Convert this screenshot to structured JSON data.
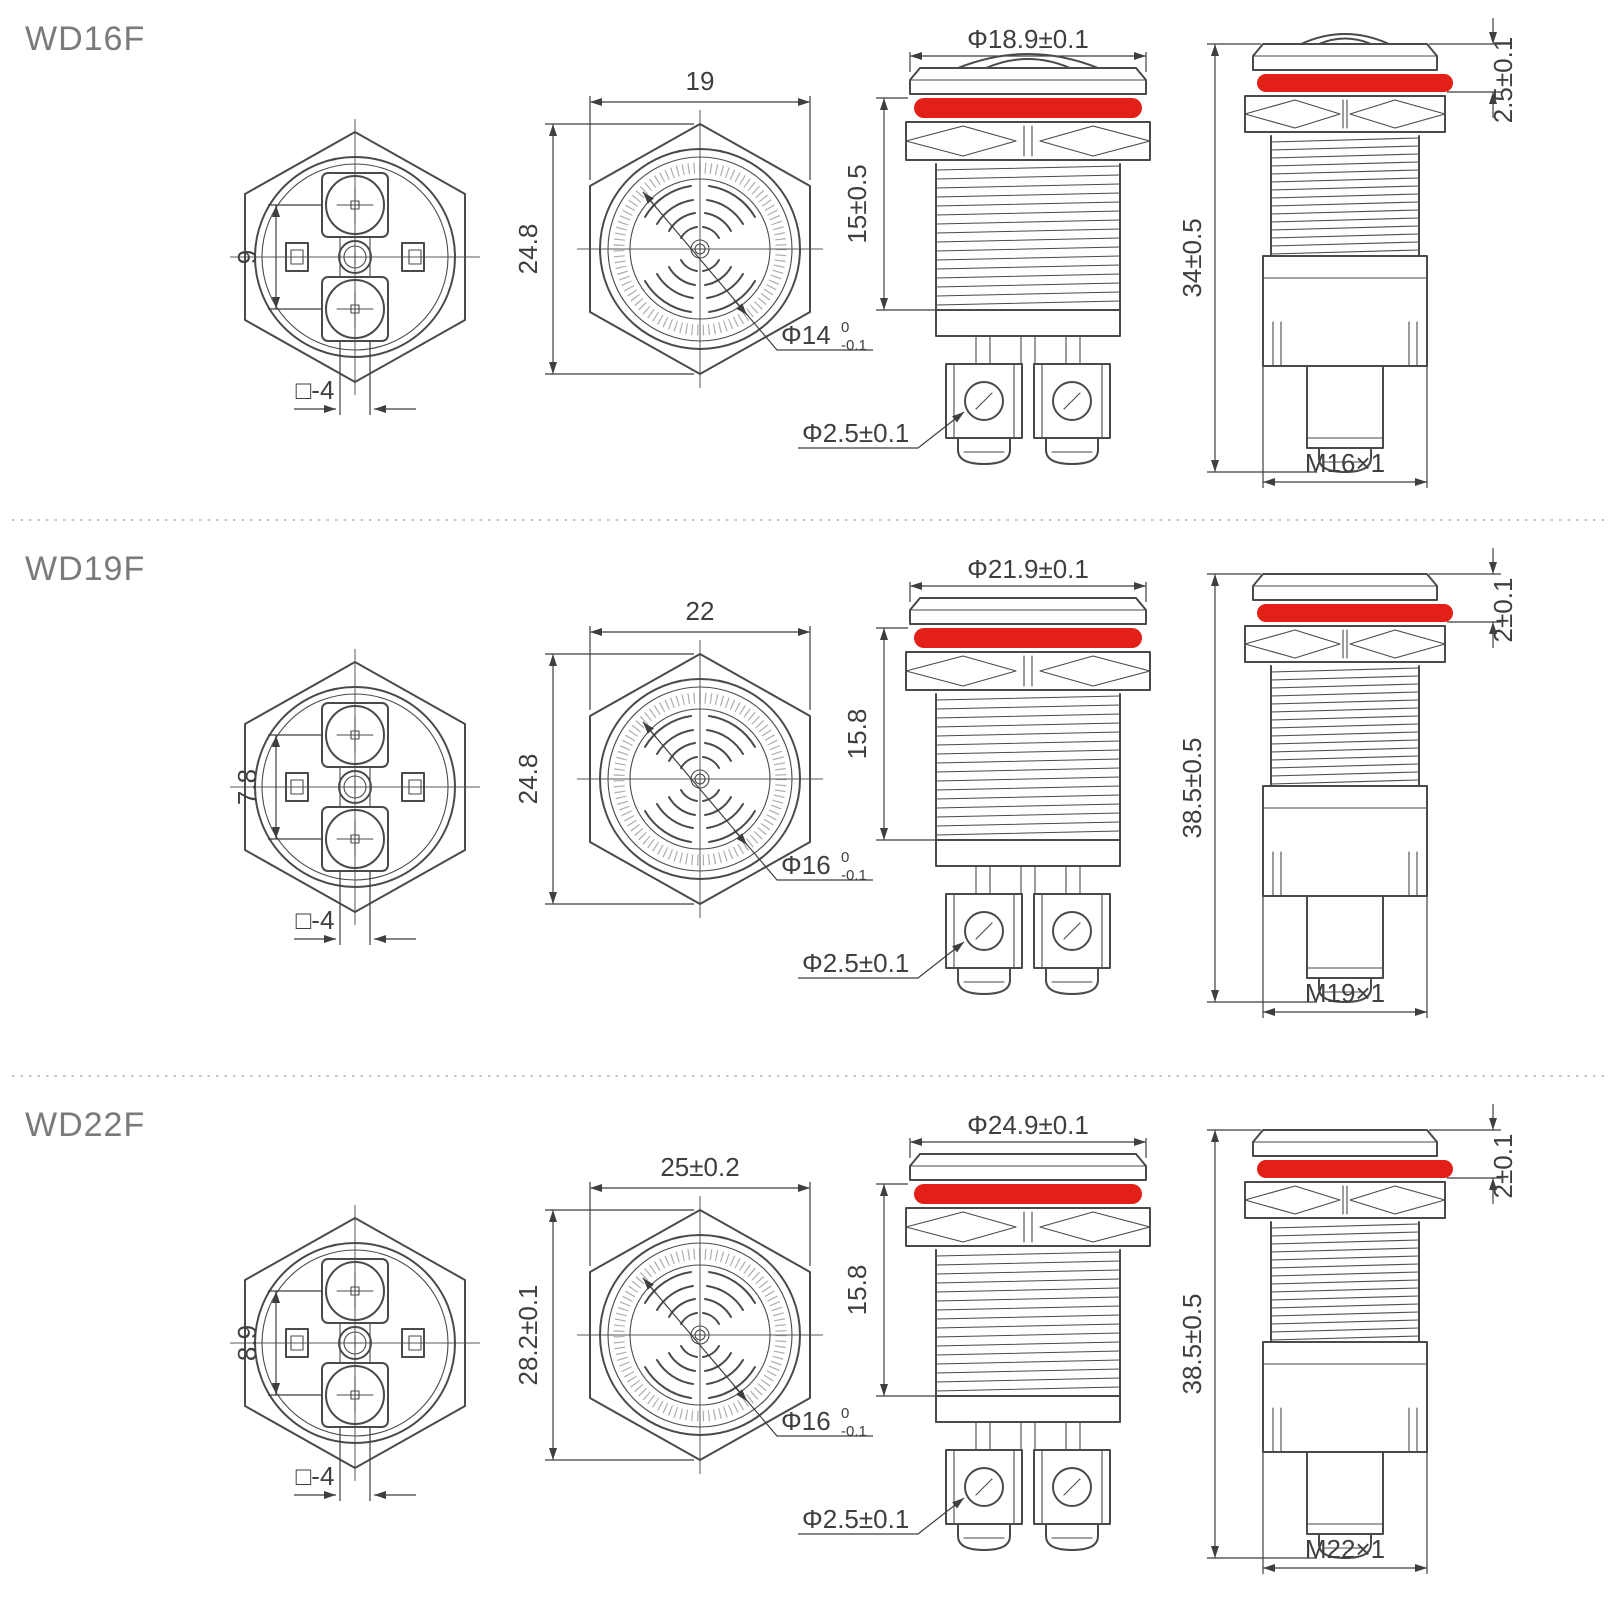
{
  "colors": {
    "line": "#4a4a4a",
    "thin": "#5a5a5a",
    "dim": "#3f3f3f",
    "red_ring": "#e32017",
    "title_text": "#7a7a7a",
    "divider": "#c6c6c6",
    "background": "#ffffff"
  },
  "sections": [
    {
      "model": "WD16F",
      "back_view": {
        "terminal_pitch": "9",
        "terminal_square": "□-4"
      },
      "front_view": {
        "width_across_flats": "19",
        "corner_height": "24.8",
        "sound_hole_dia": "Φ14",
        "tol_upper": "0",
        "tol_lower": "-0.1"
      },
      "side_view": {
        "head_dia": "Φ18.9±0.1",
        "thread_length": "15±0.5",
        "terminal_screw_dia": "Φ2.5±0.1"
      },
      "profile_view": {
        "total_height": "34±0.5",
        "head_height": "2.5±0.1",
        "thread_spec": "M16×1"
      }
    },
    {
      "model": "WD19F",
      "back_view": {
        "terminal_pitch": "7.8",
        "terminal_square": "□-4"
      },
      "front_view": {
        "width_across_flats": "22",
        "corner_height": "24.8",
        "sound_hole_dia": "Φ16",
        "tol_upper": "0",
        "tol_lower": "-0.1"
      },
      "side_view": {
        "head_dia": "Φ21.9±0.1",
        "thread_length": "15.8",
        "terminal_screw_dia": "Φ2.5±0.1"
      },
      "profile_view": {
        "total_height": "38.5±0.5",
        "head_height": "2±0.1",
        "thread_spec": "M19×1"
      }
    },
    {
      "model": "WD22F",
      "back_view": {
        "terminal_pitch": "8.9",
        "terminal_square": "□-4"
      },
      "front_view": {
        "width_across_flats": "25±0.2",
        "corner_height": "28.2±0.1",
        "sound_hole_dia": "Φ16",
        "tol_upper": "0",
        "tol_lower": "-0.1"
      },
      "side_view": {
        "head_dia": "Φ24.9±0.1",
        "thread_length": "15.8",
        "terminal_screw_dia": "Φ2.5±0.1"
      },
      "profile_view": {
        "total_height": "38.5±0.5",
        "head_height": "2±0.1",
        "thread_spec": "M22×1"
      }
    }
  ]
}
